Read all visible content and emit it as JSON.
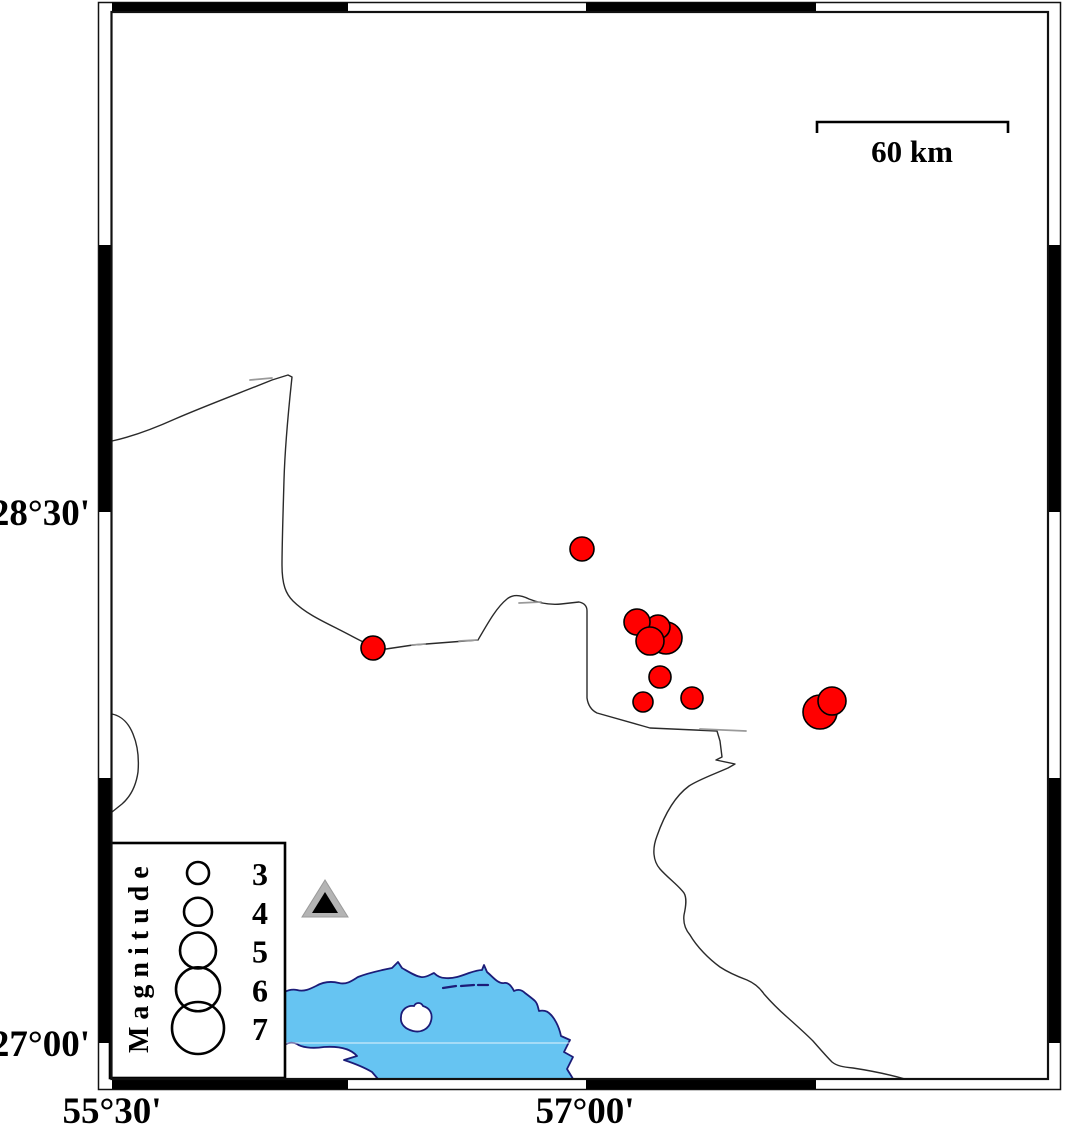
{
  "frame": {
    "lat_label_top": "28°30'",
    "lat_label_bottom": "27°00'",
    "lon_label_left": "55°30'",
    "lon_label_right": "57°00'"
  },
  "scale_bar": {
    "label": "60 km"
  },
  "legend": {
    "title": "Magnitude",
    "entries": [
      {
        "label": "3",
        "radius": 11
      },
      {
        "label": "4",
        "radius": 14
      },
      {
        "label": "5",
        "radius": 18
      },
      {
        "label": "6",
        "radius": 22
      },
      {
        "label": "7",
        "radius": 26
      }
    ]
  },
  "colors": {
    "earthquake_fill": "#ff0000",
    "earthquake_stroke": "#000000",
    "sea_fill": "#66c4f2",
    "coastline_navy": "#1c1c78",
    "land_outline": "#2a2a2a",
    "station_outer_gray": "#b4b4b4",
    "station_inner_black": "#000000",
    "frame_black": "#000000"
  },
  "earthquakes": [
    {
      "cx": 582,
      "cy": 549,
      "r": 12
    },
    {
      "cx": 373,
      "cy": 648,
      "r": 12
    },
    {
      "cx": 666,
      "cy": 638,
      "r": 16
    },
    {
      "cx": 658,
      "cy": 627,
      "r": 12
    },
    {
      "cx": 637,
      "cy": 622,
      "r": 13
    },
    {
      "cx": 650,
      "cy": 641,
      "r": 14
    },
    {
      "cx": 660,
      "cy": 677,
      "r": 11
    },
    {
      "cx": 643,
      "cy": 702,
      "r": 10
    },
    {
      "cx": 692,
      "cy": 698,
      "r": 11
    },
    {
      "cx": 820,
      "cy": 712,
      "r": 17
    },
    {
      "cx": 832,
      "cy": 701,
      "r": 14
    }
  ],
  "station": {
    "cx": 325,
    "cy": 899
  }
}
